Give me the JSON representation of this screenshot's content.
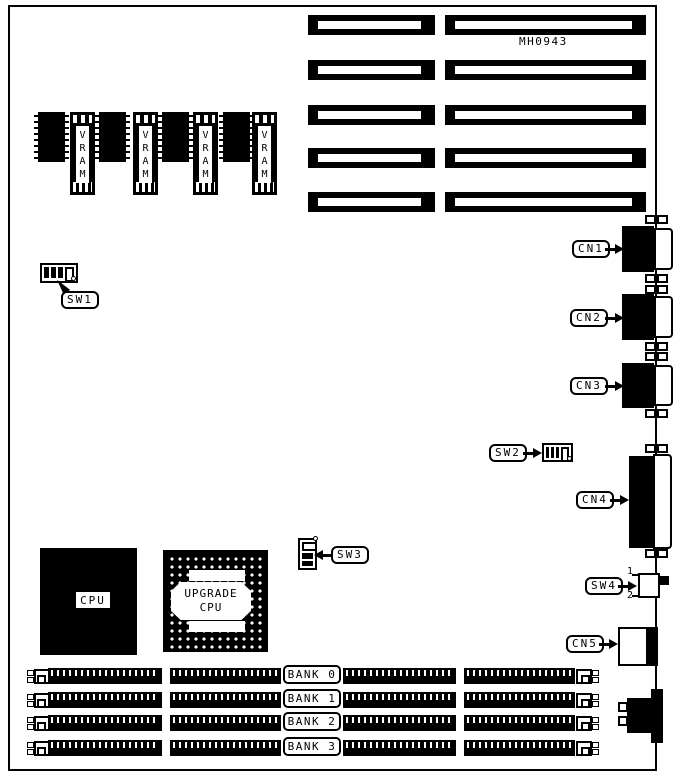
{
  "figure": {
    "part_number": "MH0943"
  },
  "vram_modules": [
    {
      "label": "VRAM"
    },
    {
      "label": "VRAM"
    },
    {
      "label": "VRAM"
    },
    {
      "label": "VRAM"
    }
  ],
  "switches": {
    "sw1": {
      "label": "SW1"
    },
    "sw2": {
      "label": "SW2"
    },
    "sw3": {
      "label": "SW3"
    },
    "sw4": {
      "label": "SW4",
      "pin_top": "1",
      "pin_bottom": "2"
    }
  },
  "connectors": {
    "cn1": {
      "label": "CN1"
    },
    "cn2": {
      "label": "CN2"
    },
    "cn3": {
      "label": "CN3"
    },
    "cn4": {
      "label": "CN4"
    },
    "cn5": {
      "label": "CN5"
    }
  },
  "processors": {
    "cpu": {
      "label": "CPU"
    },
    "upgrade_cpu": {
      "line1": "UPGRADE",
      "line2": "CPU"
    }
  },
  "memory_banks": [
    {
      "label": "BANK 0"
    },
    {
      "label": "BANK 1"
    },
    {
      "label": "BANK 2"
    },
    {
      "label": "BANK 3"
    }
  ]
}
